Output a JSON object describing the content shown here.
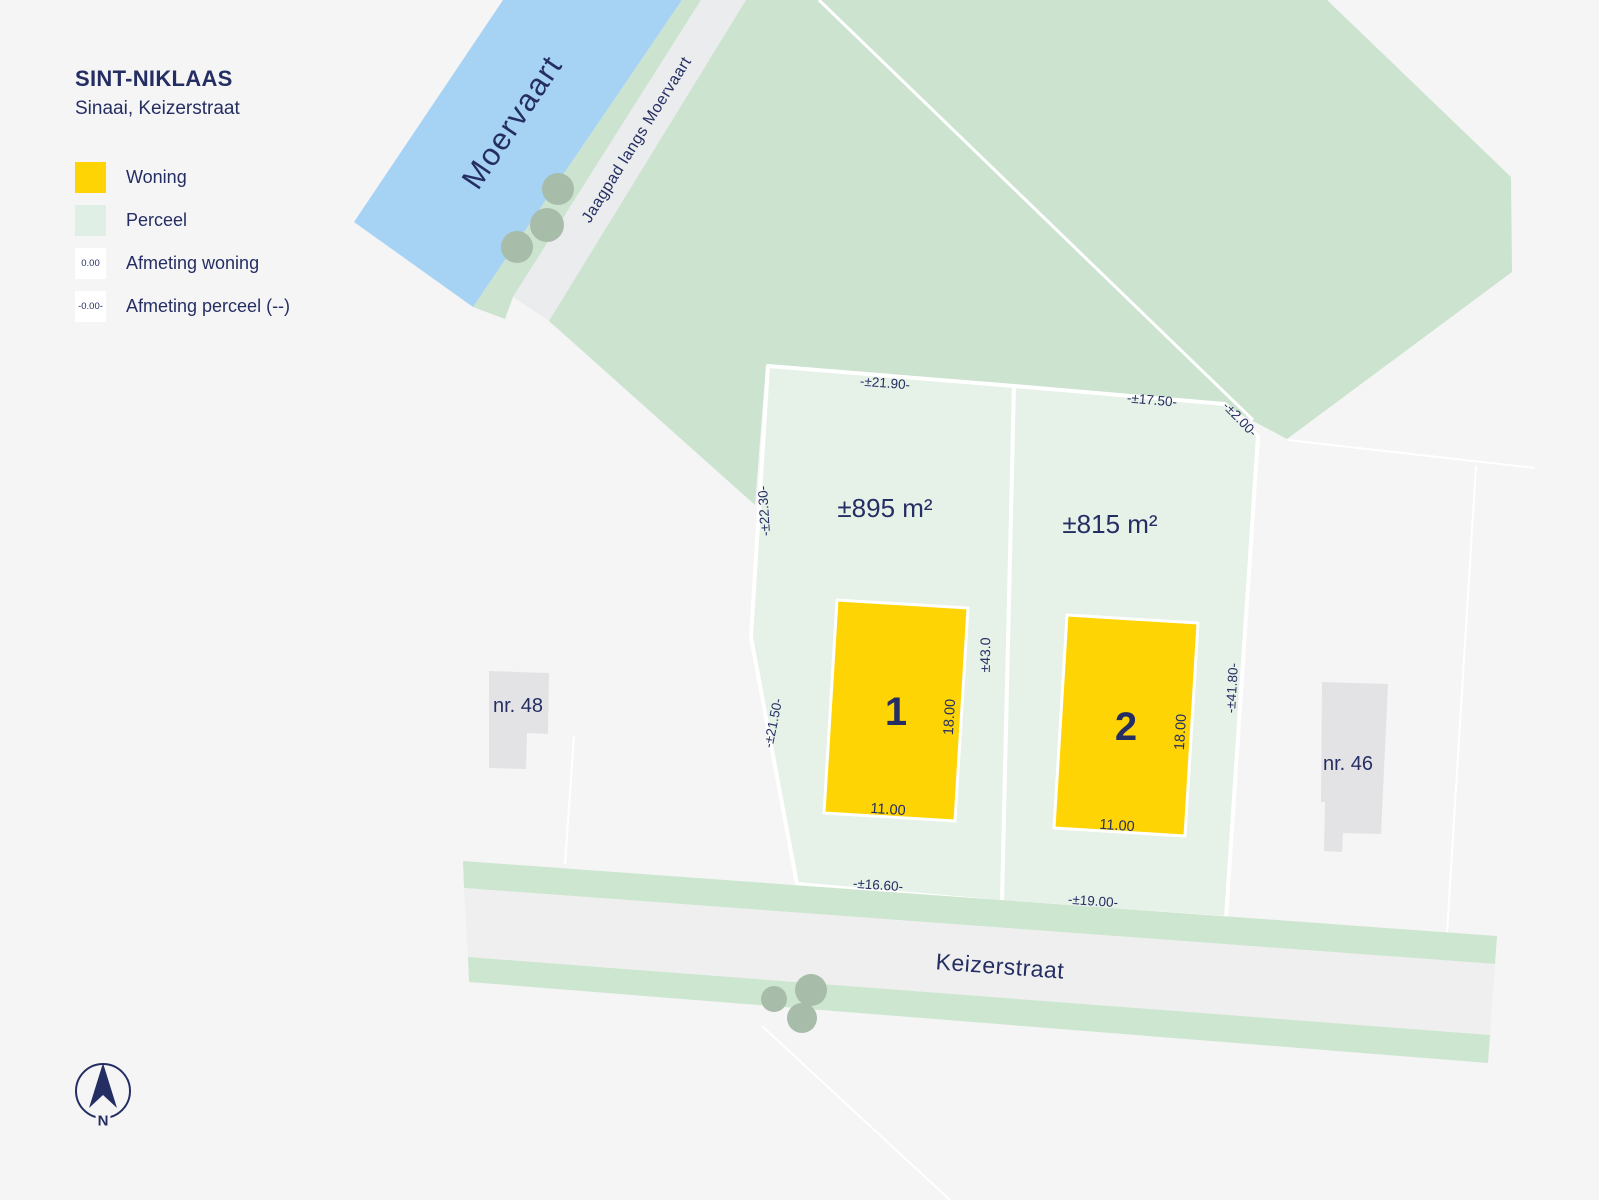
{
  "title": "SINT-NIKLAAS",
  "subtitle": "Sinaai, Keizerstraat",
  "legend": {
    "items": [
      {
        "label": "Woning",
        "swatch_color": "#FFD404"
      },
      {
        "label": "Perceel",
        "swatch_color": "#E0EFE6"
      },
      {
        "label": "Afmeting woning",
        "swatch_text": "0.00"
      },
      {
        "label": "Afmeting perceel (--)",
        "swatch_text": "-0.00-"
      }
    ]
  },
  "map": {
    "canal_label": "Moervaart",
    "towpath_label": "Jaagpad langs Moervaart",
    "street_label": "Keizerstraat",
    "compass_label": "N",
    "neighbor_left": "nr. 48",
    "neighbor_right": "nr. 46",
    "divider_dim": "±43.0",
    "plots": [
      {
        "number": "1",
        "area": "±895 m²",
        "dim_top": "-±21.90-",
        "dim_left_upper": "-±22.30-",
        "dim_left_lower": "-±21.50-",
        "dim_bottom": "-±16.60-",
        "house_width": "11.00",
        "house_depth": "18.00"
      },
      {
        "number": "2",
        "area": "±815 m²",
        "dim_top": "-±17.50-",
        "dim_top_right": "-±2.00-",
        "dim_right": "-±41.80-",
        "dim_bottom": "-±19.00-",
        "house_width": "11.00",
        "house_depth": "18.00"
      }
    ]
  },
  "colors": {
    "background": "#F5F5F6",
    "water": "#A6D2F3",
    "parcel_large": "#CBE3CF",
    "plot": "#E6F1E8",
    "house": "#FFD404",
    "road": "#EFEFEF",
    "street_verge": "#CDE6D0",
    "building": "#E3E3E5",
    "tree": "#A8BCAA",
    "text_navy": "#252E63"
  }
}
